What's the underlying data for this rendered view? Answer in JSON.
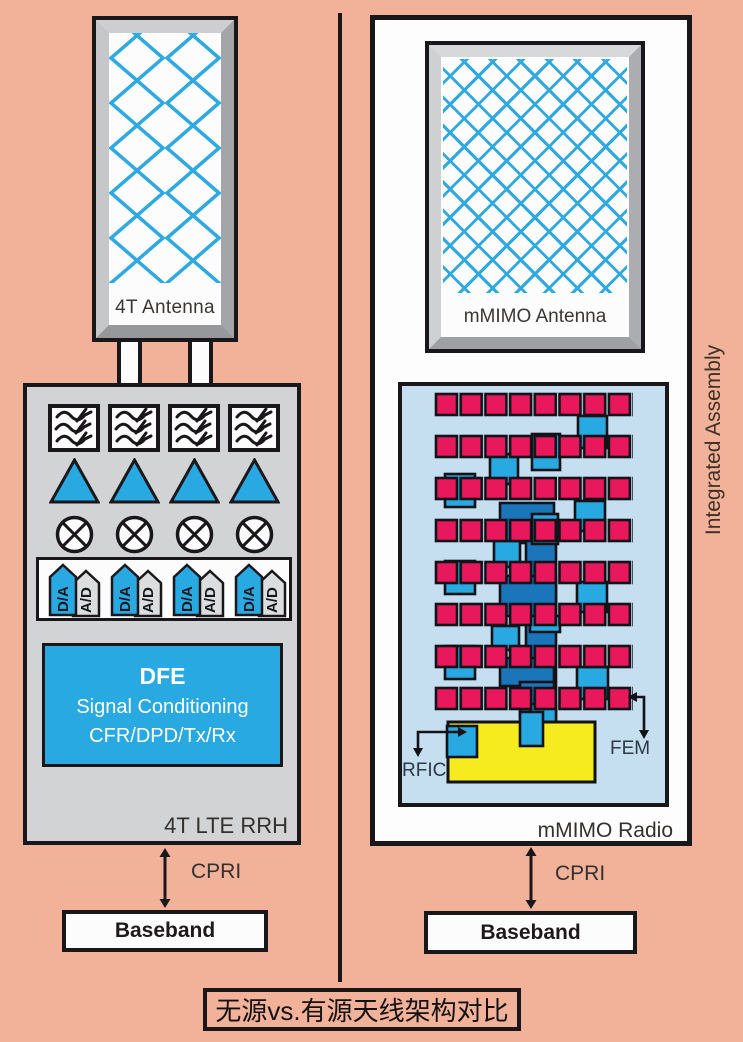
{
  "title": "无源vs.有源天线架构对比",
  "left_panel": {
    "antenna_label": "4T Antenna",
    "rrh_label": "4T LTE RRH",
    "dfe": {
      "name": "DFE",
      "line1": "Signal Conditioning",
      "line2": "CFR/DPD/Tx/Rx"
    },
    "converters": {
      "da": "D/A",
      "ad": "A/D"
    },
    "cpri": "CPRI",
    "baseband": "Baseband"
  },
  "right_panel": {
    "antenna_label": "mMIMO Antenna",
    "radio_label": "mMIMO Radio",
    "assembly_label": "Integrated Assembly",
    "rfic": "RFIC",
    "fem": "FEM",
    "cpri": "CPRI",
    "baseband": "Baseband"
  },
  "colors": {
    "background_salmon": "#F2B29A",
    "accent_blue": "#29A9E1",
    "radio_background": "#C5DEF0",
    "pink_square": "#E9185C",
    "dark_blue": "#1B75BB",
    "yellow": "#F5EB1E",
    "chassis_gray": "#D2D3D5",
    "line_black": "#1A171B"
  }
}
